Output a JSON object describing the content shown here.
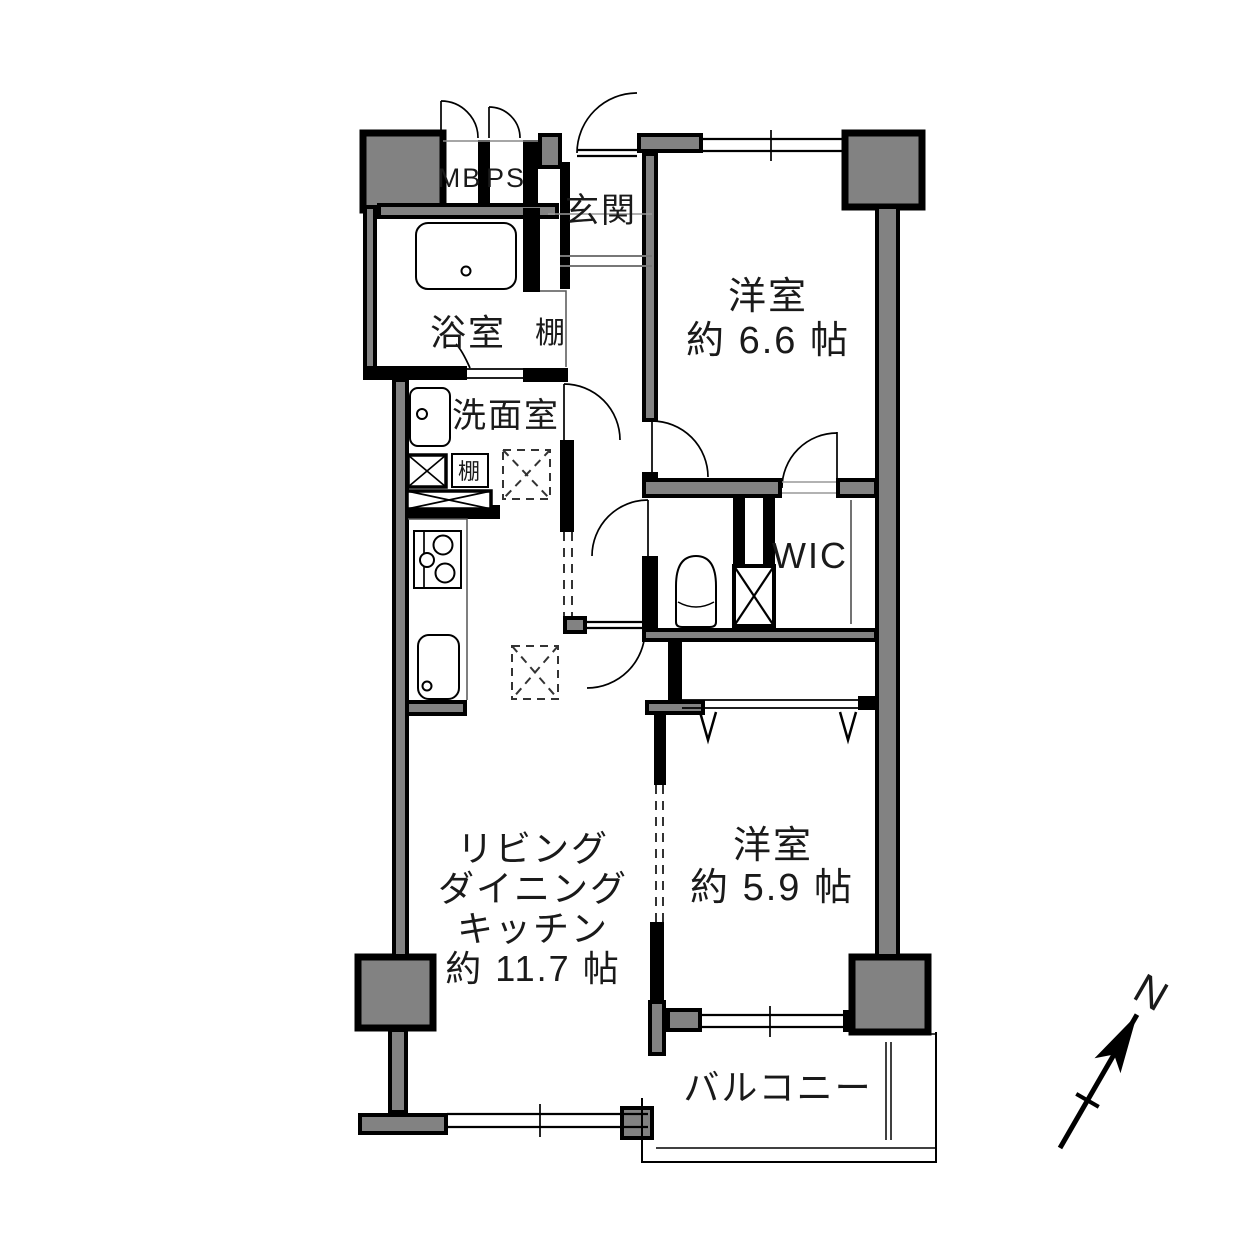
{
  "floor_plan": {
    "background": "#ffffff",
    "wall_color": "#000000",
    "pillar_color": "#828282",
    "labels": {
      "mb": "MB",
      "ps": "PS",
      "entrance": "玄関",
      "bathroom": "浴室",
      "shelf_upper": "棚",
      "washroom": "洗面室",
      "shelf_lower": "棚",
      "wic": "WIC",
      "bedroom1_name": "洋室",
      "bedroom1_size": "約 6.6 帖",
      "bedroom2_name": "洋室",
      "bedroom2_size": "約 5.9 帖",
      "ldk_line1": "リビング",
      "ldk_line2": "ダイニング",
      "ldk_line3": "キッチン",
      "ldk_size": "約 11.7 帖",
      "balcony": "バルコニー",
      "compass_north": "N"
    }
  }
}
